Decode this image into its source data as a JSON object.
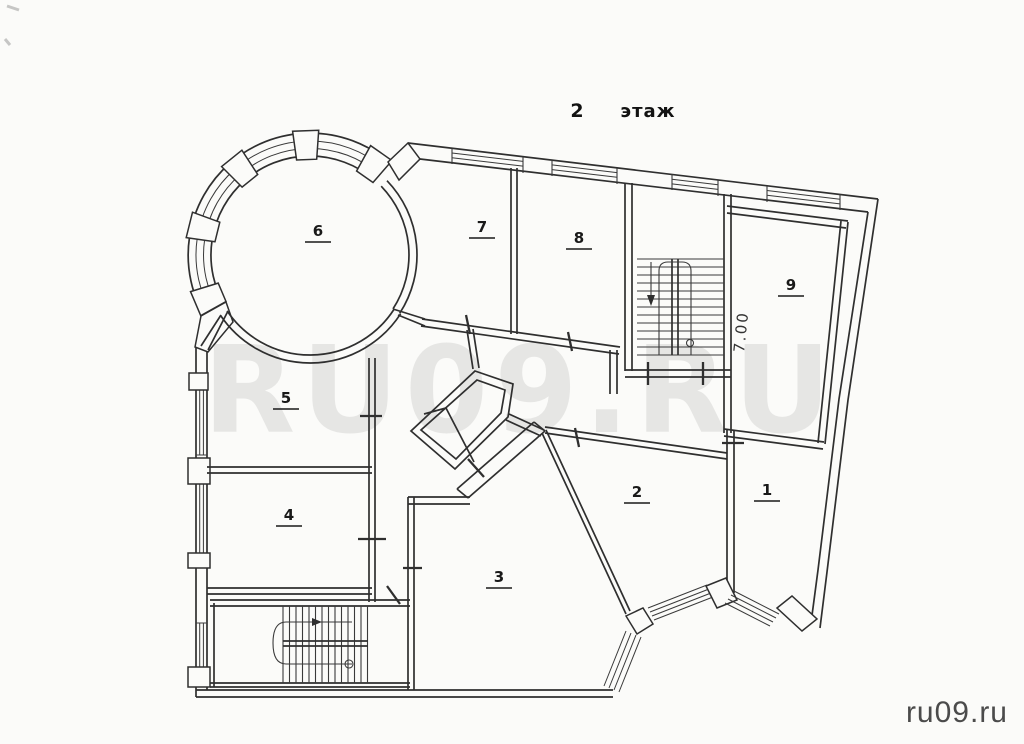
{
  "title": {
    "number": "2",
    "word": "этаж"
  },
  "watermark": {
    "text": "RU09.RU"
  },
  "footer": {
    "site": "ru09.ru"
  },
  "dimension": {
    "value": "7.00"
  },
  "rooms": [
    {
      "number": "1"
    },
    {
      "number": "2"
    },
    {
      "number": "3"
    },
    {
      "number": "4"
    },
    {
      "number": "5"
    },
    {
      "number": "6"
    },
    {
      "number": "7"
    },
    {
      "number": "8"
    },
    {
      "number": "9"
    }
  ],
  "colors": {
    "ink": "#2f2f2f",
    "paper": "#fbfbf9",
    "watermark_gray": "#e4e4e2",
    "footer_text": "#4b4b4b"
  }
}
